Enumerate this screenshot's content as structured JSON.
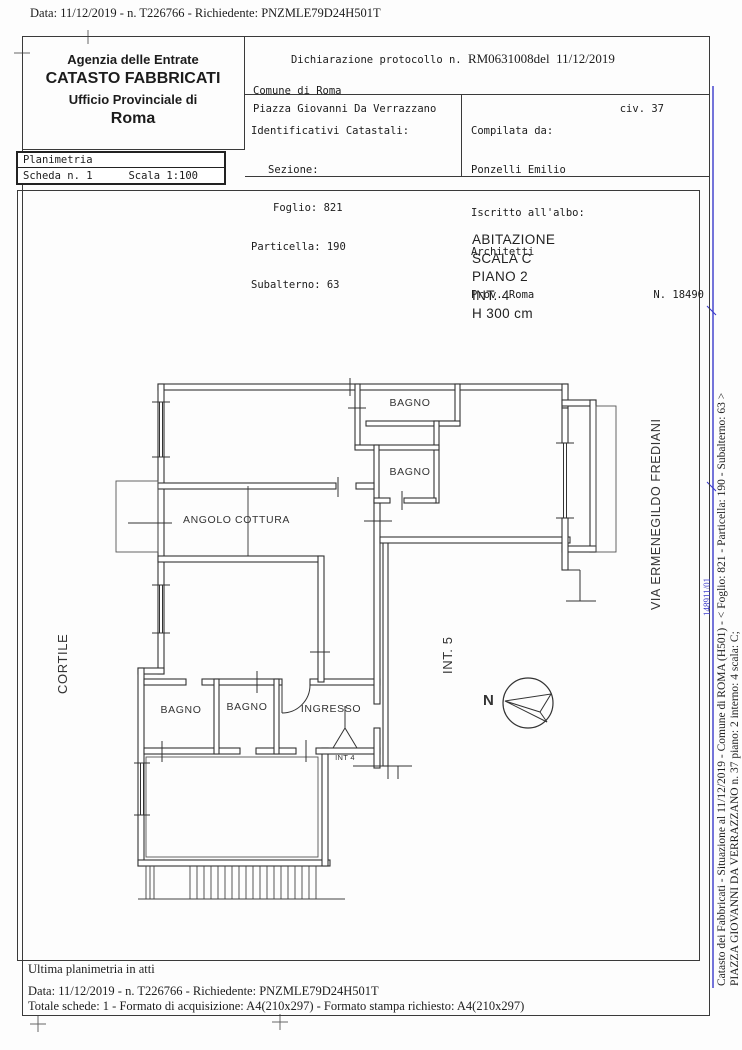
{
  "page": {
    "top_line": "Data: 11/12/2019 - n. T226766 - Richiedente: PNZMLE79D24H501T"
  },
  "header": {
    "agency": {
      "line1": "Agenzia delle Entrate",
      "line2": "CATASTO FABBRICATI",
      "line3": "Ufficio Provinciale di",
      "line4": "Roma"
    },
    "planimetria": {
      "title": "Planimetria",
      "scheda": "Scheda n. 1",
      "scala": "Scala 1:100"
    },
    "declaration": {
      "protocol_prefix": "Dichiarazione protocollo n. ",
      "protocol_number": "RM0631008del",
      "protocol_date": "11/12/2019",
      "comune": "Comune di Roma",
      "address": "Piazza Giovanni Da Verrazzano",
      "civ": "civ. 37"
    },
    "identifiers": {
      "title": "Identificativi Catastali:",
      "sezione": "Sezione:",
      "foglio": "Foglio: 821",
      "particella": "Particella: 190",
      "subalterno": "Subalterno: 63"
    },
    "compiler": {
      "compilata": "Compilata da:",
      "name": "Ponzelli Emilio",
      "albo": "Iscritto all'albo:",
      "albo_name": "Architetti",
      "prov": "Prov. Roma",
      "number": "N. 18490"
    }
  },
  "plan": {
    "unit_info": [
      "ABITAZIONE",
      "SCALA C",
      "PIANO 2",
      "INT. 4",
      "H 300 cm"
    ],
    "rooms": {
      "bagno_top": "BAGNO",
      "bagno_mid": "BAGNO",
      "angolo_cottura": "ANGOLO COTTURA",
      "bagno_low_left": "BAGNO",
      "bagno_low_mid": "BAGNO",
      "ingresso": "INGRESSO",
      "int4": "INT 4",
      "int5": "INT. 5"
    },
    "context": {
      "cortile": "CORTILE",
      "street": "VIA ERMENEGILDO FREDIANI",
      "north": "N"
    }
  },
  "footer": {
    "note": "Ultima planimetria in atti",
    "line1": "Data: 11/12/2019 - n. T226766 - Richiedente: PNZMLE79D24H501T",
    "line2": "Totale schede: 1 - Formato di acquisizione: A4(210x297)  - Formato stampa richiesto: A4(210x297)"
  },
  "margin": {
    "right_line1": "Catasto dei Fabbricati - Situazione al 11/12/2019 - Comune di ROMA (H501) - <  Foglio: 821 - Particella: 190 - Subalterno: 63 >",
    "right_line2": "PIAZZA GIOVANNI DA VERRAZZANO n. 37 piano: 2 interno: 4 scala: C;",
    "blue_code": "148911/01"
  },
  "colors": {
    "blue": "#3a3acb",
    "ink": "#333333"
  }
}
